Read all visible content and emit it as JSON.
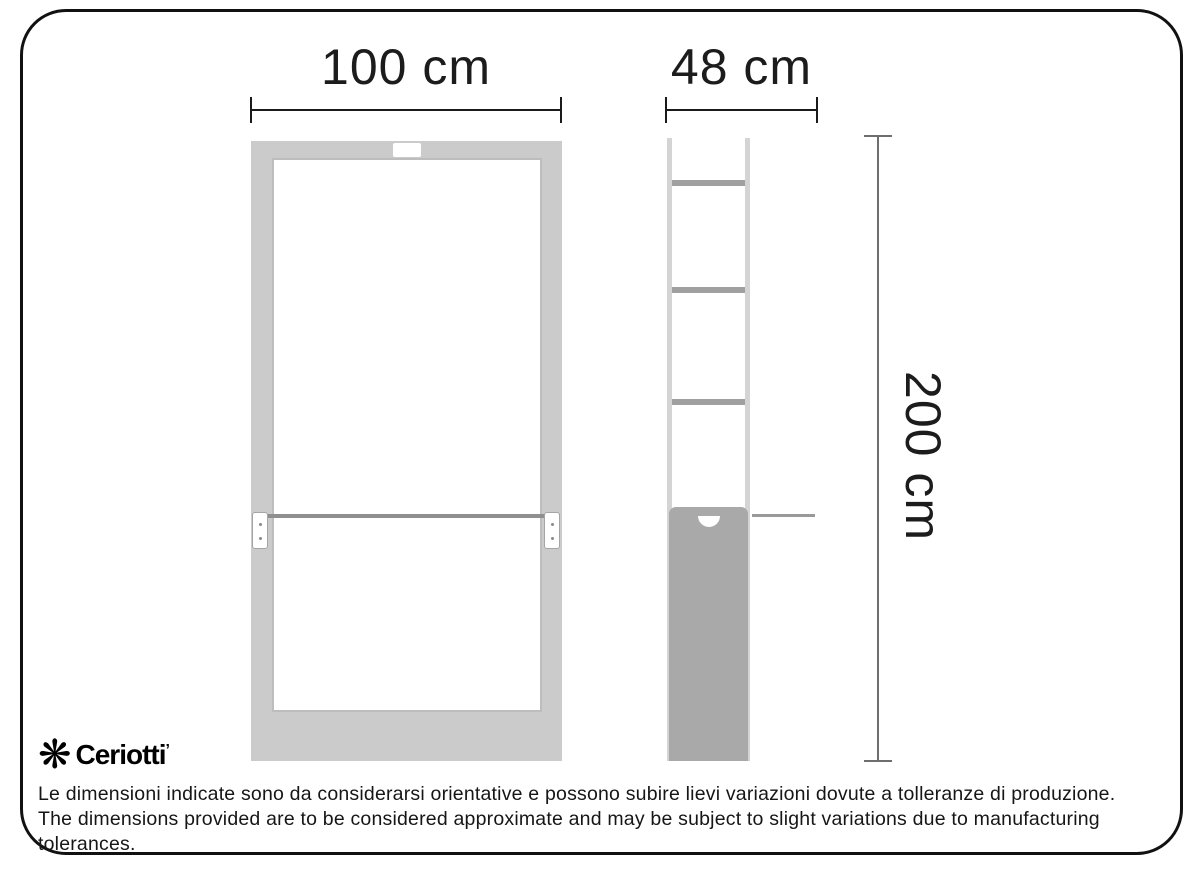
{
  "diagram": {
    "kind": "product-dimension-drawing",
    "views": {
      "front": {
        "width_label": "100 cm"
      },
      "side": {
        "depth_label": "48 cm"
      },
      "height_label": "200 cm"
    }
  },
  "brand": {
    "name": "Ceriotti",
    "trademark_mark": "ʼ",
    "logo_icon": "pinwheel-asterisk-icon",
    "logo_glyph": "❋"
  },
  "disclaimer": {
    "line_italian": "Le dimensioni indicate sono da considerarsi orientative e possono subire lievi variazioni dovute a tolleranze di produzione.",
    "line_english": "The dimensions provided are to be considered approximate and may be subject to slight variations due to manufacturing tolerances."
  },
  "colors": {
    "frame_gray": "#cbcbcb",
    "rail_gray": "#d4d4d4",
    "bar_gray": "#a0a0a0",
    "panel_fill_gray": "#a9a9a9",
    "shelf_line_gray": "#8f8f8f",
    "dimension_line_black": "#1a1a1a",
    "dimension_line_gray": "#6e6e6e",
    "border_black": "#111111"
  }
}
